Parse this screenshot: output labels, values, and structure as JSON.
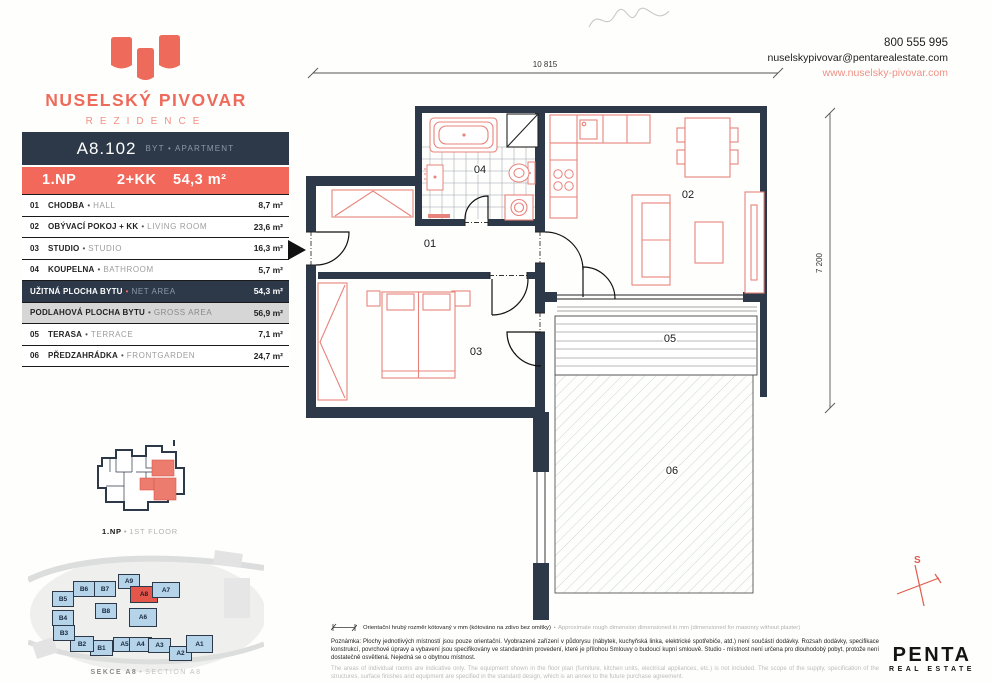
{
  "brand": {
    "name": "NUSELSKÝ PIVOVAR",
    "subtitle": "REZIDENCE"
  },
  "contact": {
    "phone": "800 555 995",
    "email": "nuselskypivovar@pentarealestate.com",
    "web": "www.nuselsky-pivovar.com"
  },
  "unit": {
    "code": "A8.102",
    "type_cz": "BYT",
    "type_en": "APARTMENT",
    "floor": "1.NP",
    "layout": "2+KK",
    "area": "54,3 m²"
  },
  "rooms": [
    {
      "num": "01",
      "cz": "CHODBA",
      "en": "HALL",
      "area": "8,7 m²"
    },
    {
      "num": "02",
      "cz": "OBÝVACÍ POKOJ + KK",
      "en": "LIVING ROOM",
      "area": "23,6 m²"
    },
    {
      "num": "03",
      "cz": "STUDIO",
      "en": "STUDIO",
      "area": "16,3 m²"
    },
    {
      "num": "04",
      "cz": "KOUPELNA",
      "en": "BATHROOM",
      "area": "5,7 m²"
    }
  ],
  "totals": [
    {
      "cz": "UŽITNÁ PLOCHA BYTU",
      "en": "NET AREA",
      "area": "54,3 m²"
    },
    {
      "cz": "PODLAHOVÁ PLOCHA BYTU",
      "en": "GROSS AREA",
      "area": "56,9 m²"
    }
  ],
  "outdoor": [
    {
      "num": "05",
      "cz": "TERASA",
      "en": "TERRACE",
      "area": "7,1 m²"
    },
    {
      "num": "06",
      "cz": "PŘEDZAHRÁDKA",
      "en": "FRONTGARDEN",
      "area": "24,7 m²"
    }
  ],
  "plan": {
    "dim_width": "10 815",
    "dim_height": "7 200",
    "compass": "S",
    "labels": {
      "r01": "01",
      "r02": "02",
      "r03": "03",
      "r04": "04",
      "r05": "05",
      "r06": "06"
    }
  },
  "mini_plan": {
    "caption_cz": "1.NP",
    "caption_en": "1ST FLOOR"
  },
  "site_map": {
    "caption_cz": "SEKCE A8",
    "caption_en": "SECTION A8",
    "buildings": [
      {
        "label": "A9"
      },
      {
        "label": "A8"
      },
      {
        "label": "A7"
      },
      {
        "label": "A6"
      },
      {
        "label": "A5"
      },
      {
        "label": "A4"
      },
      {
        "label": "A3"
      },
      {
        "label": "A2"
      },
      {
        "label": "A1"
      },
      {
        "label": "B1"
      },
      {
        "label": "B2"
      },
      {
        "label": "B3"
      },
      {
        "label": "B4"
      },
      {
        "label": "B5"
      },
      {
        "label": "B6"
      },
      {
        "label": "B7"
      },
      {
        "label": "B8"
      }
    ]
  },
  "notes": {
    "dim_cz": "Orientační hrubý rozměr kótovaný v mm (kótováno na zdivo bez omítky)",
    "dim_en": "Approximate rough dimension dimensioned in mm (dimensioned for masonry without plaster)",
    "body_cz": "Poznámka: Plochy jednotlivých místností jsou pouze orientační. Vyobrazené zařízení v půdorysu (nábytek, kuchyňská linka, elektrické spotřebiče, atd.) není součástí dodávky. Rozsah dodávky, specifikace konstrukcí, povrchové úpravy a vybavení jsou specifikovány ve standardním provedení, které je přílohou Smlouvy o budoucí kupní smlouvě. Studio - místnost není určena pro dlouhodobý pobyt, protože není dostatečně osvětlená. Nejedná se o obytnou místnost.",
    "body_en": "The areas of individual rooms are indicative only. The equipment shown in the floor plan (furniture, kitchen units, electrical appliances, etc.) is not included. The scope of the supply, specification of the structures, surface finishes and equipment are specified in the standard design, which is an annex to the future purchase agreement."
  },
  "penta": {
    "name": "PENTA",
    "tagline": "REAL ESTATE"
  },
  "ui": {
    "bullet": "•"
  }
}
